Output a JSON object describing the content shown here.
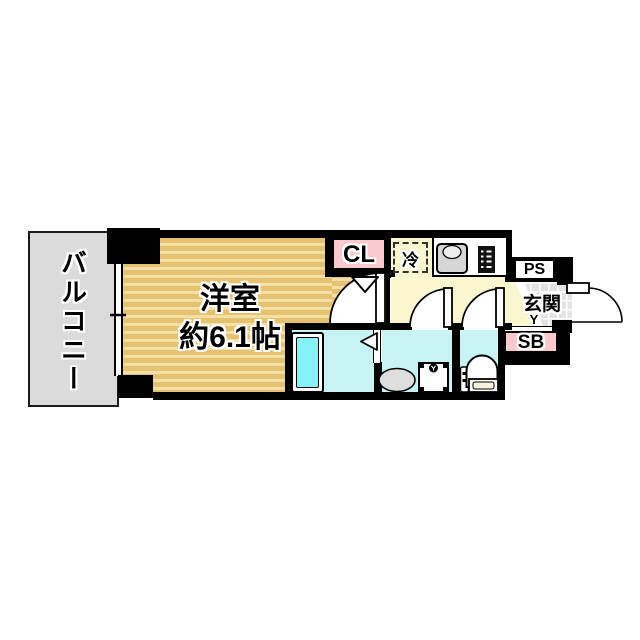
{
  "floorplan": {
    "labels": {
      "balcony": "バルコニー",
      "room_name": "洋室",
      "room_size": "約6.1帖",
      "closet": "CL",
      "refrigerator": "冷",
      "pipe_space": "PS",
      "entrance": "玄関",
      "entrance_mark": "Y",
      "shoe_box": "SB"
    },
    "fixture_icons": [
      "bathtub-icon",
      "wash-basin-icon",
      "washing-machine-pan-icon",
      "toilet-icon",
      "kitchen-sink-icon",
      "stove-icon",
      "entrance-door-swing-icon",
      "room-door-swing-icon",
      "washroom-door-swing-icon",
      "toilet-door-swing-icon",
      "closet-folding-door-icon",
      "bathroom-folding-door-icon",
      "balcony-window-icon"
    ],
    "colors": {
      "room_floor": "#E6C16F",
      "room_floor_stripe": "#F2E0A6",
      "kitchen_floor": "#FAF6CF",
      "wet_area_floor": "#C7F3F5",
      "bathtub_water": "#84F2F6",
      "closet_fill": "#F9C9CE",
      "shoe_box_fill": "#F9C9CE",
      "balcony_floor": "#DBDBDB",
      "entrance_tile": "#E3E3E3",
      "wall": "#000000"
    }
  }
}
